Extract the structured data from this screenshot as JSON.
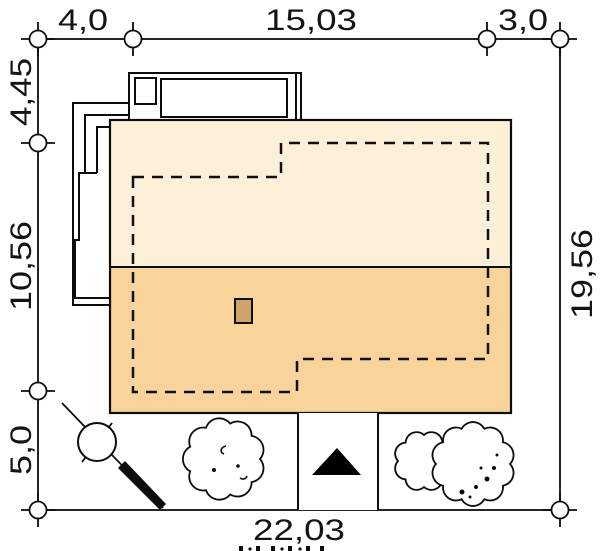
{
  "dimensions": {
    "top": [
      "4,0",
      "15,03",
      "3,0"
    ],
    "left": [
      "4,45",
      "10,56",
      "5,0"
    ],
    "right": "19,56",
    "bottom": "22,03"
  },
  "colors": {
    "plot_background": "#f1f1f1",
    "roof_upper": "#fcf0d8",
    "roof_lower": "#f8d39a",
    "chimney": "#d0a469",
    "outline": "#0d0d0d",
    "arrow": "#000000"
  },
  "icons": {
    "entrance_arrow": "filled-triangle-up",
    "tree": "scalloped-canopy-circle",
    "utility_pole": "circle-with-diagonal-service-line"
  }
}
